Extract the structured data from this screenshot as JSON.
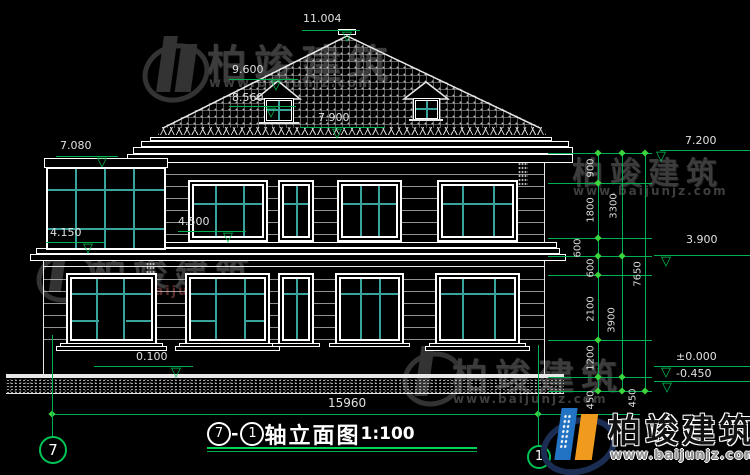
{
  "title": {
    "axis_from": "7",
    "axis_to": "1",
    "name": "轴立面图",
    "scale": "1:100"
  },
  "axis": {
    "left_bubble": "7",
    "right_bubble": "1"
  },
  "elev": {
    "e11004": "11.004",
    "e9600": "9.600",
    "e8560": "8.560",
    "e7900": "7.900",
    "e7080": "7.080",
    "e4500": "4.500",
    "e4150": "4.150",
    "e0100": "0.100",
    "e7200": "7.200",
    "e3900": "3.900",
    "e0000": "±0.000",
    "em0450": "-0.450"
  },
  "dims": {
    "total_width": "15960",
    "chain_a": [
      "900",
      "1800",
      "600",
      "600",
      "2100",
      "1200",
      "450"
    ],
    "chain_b": [
      "3300",
      "3900",
      "450"
    ],
    "chain_c": [
      "7650"
    ]
  },
  "watermark": {
    "brand": "柏竣建筑",
    "site": "www.baijunjz.com"
  },
  "icons": {
    "tri": "▽"
  },
  "colors": {
    "background": "#000000",
    "line_white": "#e8e8e8",
    "dim_green": "#00b050",
    "mullion_teal": "#3aa39d",
    "watermark_gray": "#3c3c3c",
    "watermark_red": "#5c2b2b",
    "logo_blue": "#2273c4",
    "logo_orange": "#f09a1e",
    "logo_navy": "#1b2d52"
  }
}
